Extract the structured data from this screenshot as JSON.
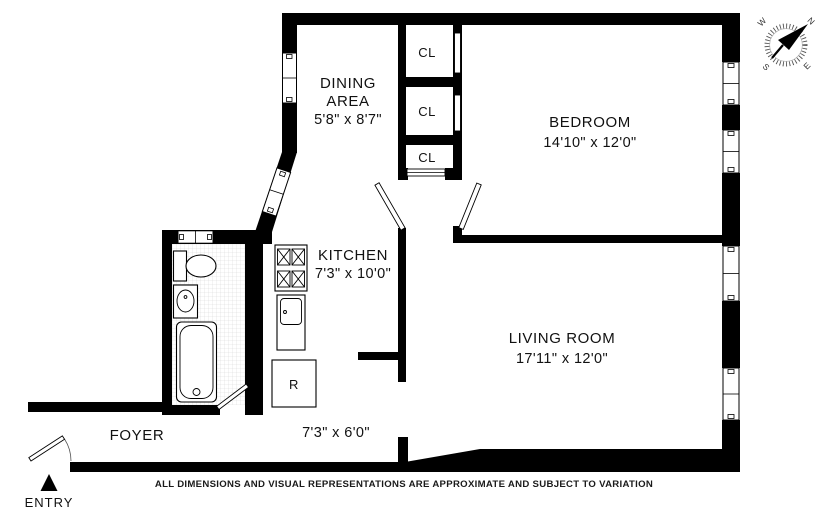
{
  "plan": {
    "rooms": {
      "dining": {
        "label_line1": "DINING",
        "label_line2": "AREA",
        "dims": "5'8\" x 8'7\""
      },
      "bedroom": {
        "label": "BEDROOM",
        "dims": "14'10\" x 12'0\""
      },
      "kitchen": {
        "label": "KITCHEN",
        "dims": "7'3\" x 10'0\""
      },
      "living_room": {
        "label": "LIVING ROOM",
        "dims": "17'11\" x 12'0\""
      },
      "foyer": {
        "label": "FOYER"
      },
      "hall": {
        "dims": "7'3\" x 6'0\""
      }
    },
    "closets": {
      "closet1": "CL",
      "closet2": "CL",
      "closet3": "CL"
    },
    "appliances": {
      "refrigerator": "R"
    },
    "entry": {
      "label": "ENTRY"
    },
    "compass": {
      "north": "N",
      "east": "E",
      "south": "S",
      "west": "W"
    },
    "disclaimer": "ALL DIMENSIONS AND VISUAL REPRESENTATIONS ARE APPROXIMATE AND SUBJECT TO VARIATION",
    "colors": {
      "wall": "#000000",
      "background": "#ffffff",
      "text": "#111111",
      "tile_line": "#d8d8d8"
    }
  }
}
